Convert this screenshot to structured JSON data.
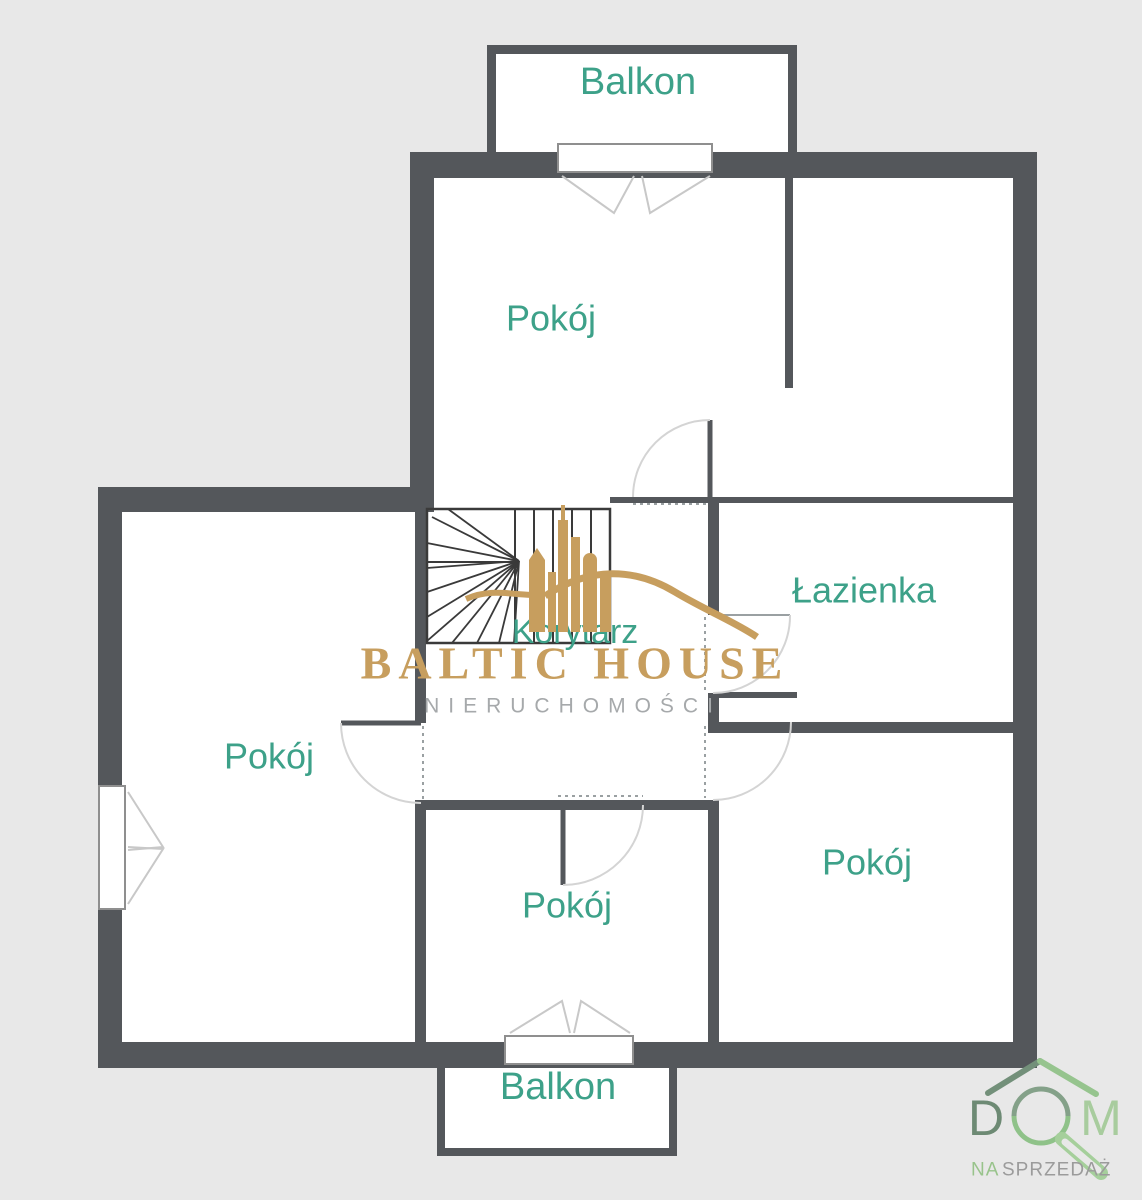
{
  "page": {
    "background": "#e8e8e8"
  },
  "plan": {
    "wall_color": "#54575b",
    "label_color": "#3da189",
    "labels": {
      "balcony_top": "Balkon",
      "room_top": "Pokój",
      "bathroom": "Łazienka",
      "corridor": "Korytarz",
      "room_left": "Pokój",
      "room_bottom_middle": "Pokój",
      "room_bottom_right": "Pokój",
      "balcony_bottom": "Balkon"
    }
  },
  "watermark": {
    "brand": "BALTIC HOUSE",
    "tagline": "NIERUCHOMOŚCI",
    "brand_color": "#c79e5e",
    "tagline_color": "#a6a9ab"
  },
  "badge": {
    "word_left": "D",
    "word_right": "M",
    "sub_left": "NA",
    "sub_right": "SPRZEDAŻ",
    "color_dark_green": "#6d8a74",
    "color_light_green": "#a8cc9e"
  }
}
